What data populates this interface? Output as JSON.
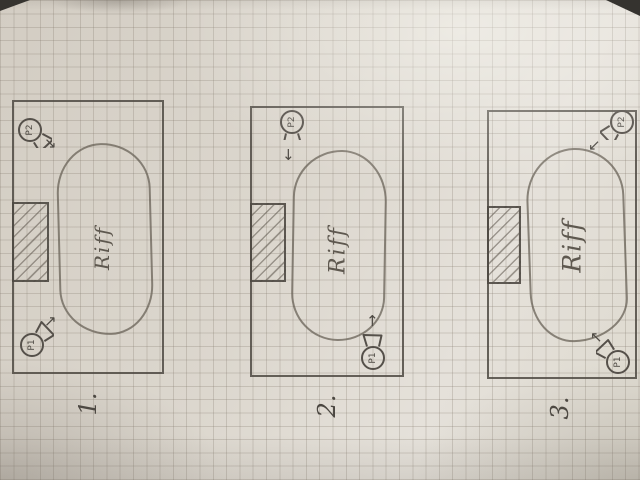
{
  "sketch": {
    "ink_color": "#55504a",
    "paper_color": "#d8d2c8",
    "grid_color": "#8e857a",
    "diagrams": [
      {
        "number_label": "1.",
        "zone_label": "Riff",
        "obstacle": "hatched-block-left-wall",
        "players": [
          {
            "label": "P2",
            "arrow_glyph": "↘",
            "position": "top-left",
            "facing": "down-right"
          },
          {
            "label": "P1",
            "arrow_glyph": "↗",
            "position": "bottom-left",
            "facing": "up-right"
          }
        ]
      },
      {
        "number_label": "2.",
        "zone_label": "Riff",
        "obstacle": "hatched-block-left-wall",
        "players": [
          {
            "label": "P2",
            "arrow_glyph": "↓",
            "position": "top-center",
            "facing": "down"
          },
          {
            "label": "P1",
            "arrow_glyph": "↑",
            "position": "bottom-right",
            "facing": "up"
          }
        ]
      },
      {
        "number_label": "3.",
        "zone_label": "Riff",
        "obstacle": "hatched-block-left-wall",
        "players": [
          {
            "label": "P2",
            "arrow_glyph": "↙",
            "position": "top-right",
            "facing": "down-left"
          },
          {
            "label": "P1",
            "arrow_glyph": "↖",
            "position": "bottom-right",
            "facing": "up-left"
          }
        ]
      }
    ]
  }
}
